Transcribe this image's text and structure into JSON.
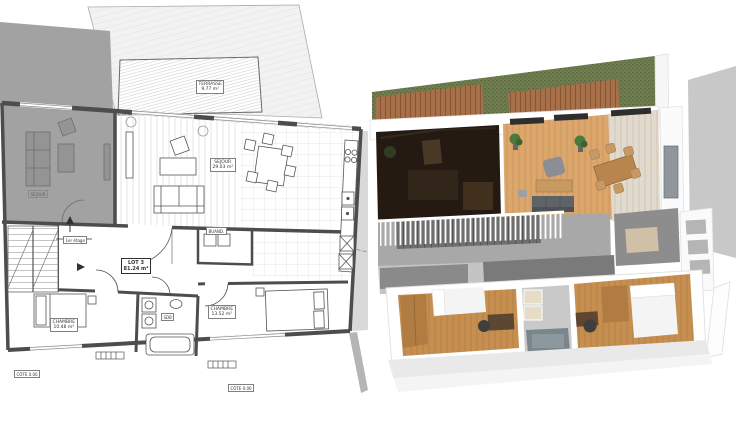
{
  "plan2d": {
    "type": "2d-floor-plan",
    "labels": {
      "terrasse": {
        "name": "TERRASSE",
        "area": "9.77 m²"
      },
      "sejour": {
        "name": "SEJOUR",
        "area": "29.03 m²"
      },
      "buanderie": {
        "name": "BUAND."
      },
      "etage": {
        "name": "1er étage"
      },
      "lot": {
        "name": "LOT 3",
        "area": "81.24 m²"
      },
      "chambre_1": {
        "name": "CHAMBRE",
        "area": "10.48 m²"
      },
      "sdb": {
        "name": "SDB"
      },
      "chambre_2": {
        "name": "CHAMBRE",
        "area": "13.52 m²"
      },
      "voisin": {
        "name": "SÉJOUR"
      },
      "cote_gauche": {
        "name": "CÔTE 0.00"
      },
      "cote_bas": {
        "name": "CÔTE 0.00"
      }
    },
    "colors": {
      "wall": "#4d4d4d",
      "neighbor_fill": "#a2a2a2",
      "roof_fill": "#f2f2f2",
      "right_neighbor_fill": "#d9d9d9"
    }
  },
  "render3d": {
    "type": "3d-floor-plan-render",
    "colors": {
      "grass": "#6f7d4f",
      "deck_wood": "#a77048",
      "living_wood": "#dda76c",
      "stone_floor": "#e2dbcd",
      "bedroom_wood": "#c68e4f",
      "hall_floor": "#a8a8a8",
      "dark_room": "#241a12",
      "wall_gray": "#c8c8c8",
      "tub": "#7b868c",
      "sofa": "#5f6368",
      "bed_white": "#f4f4f4"
    }
  }
}
